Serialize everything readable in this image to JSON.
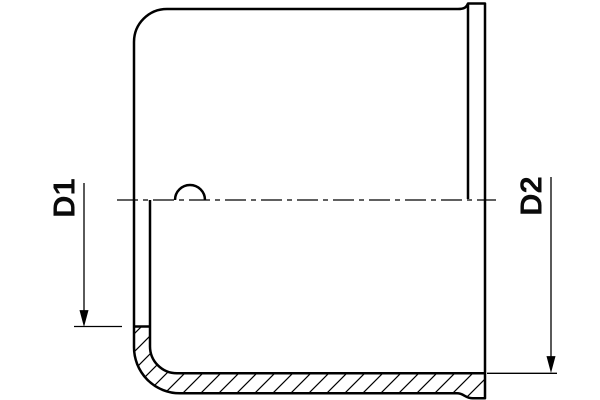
{
  "drawing": {
    "title": "pipe-end-cap-cross-section",
    "background_color": "#ffffff",
    "line_color": "#000000"
  },
  "dimensions": {
    "d1": {
      "label": "D1"
    },
    "d2": {
      "label": "D2"
    }
  }
}
